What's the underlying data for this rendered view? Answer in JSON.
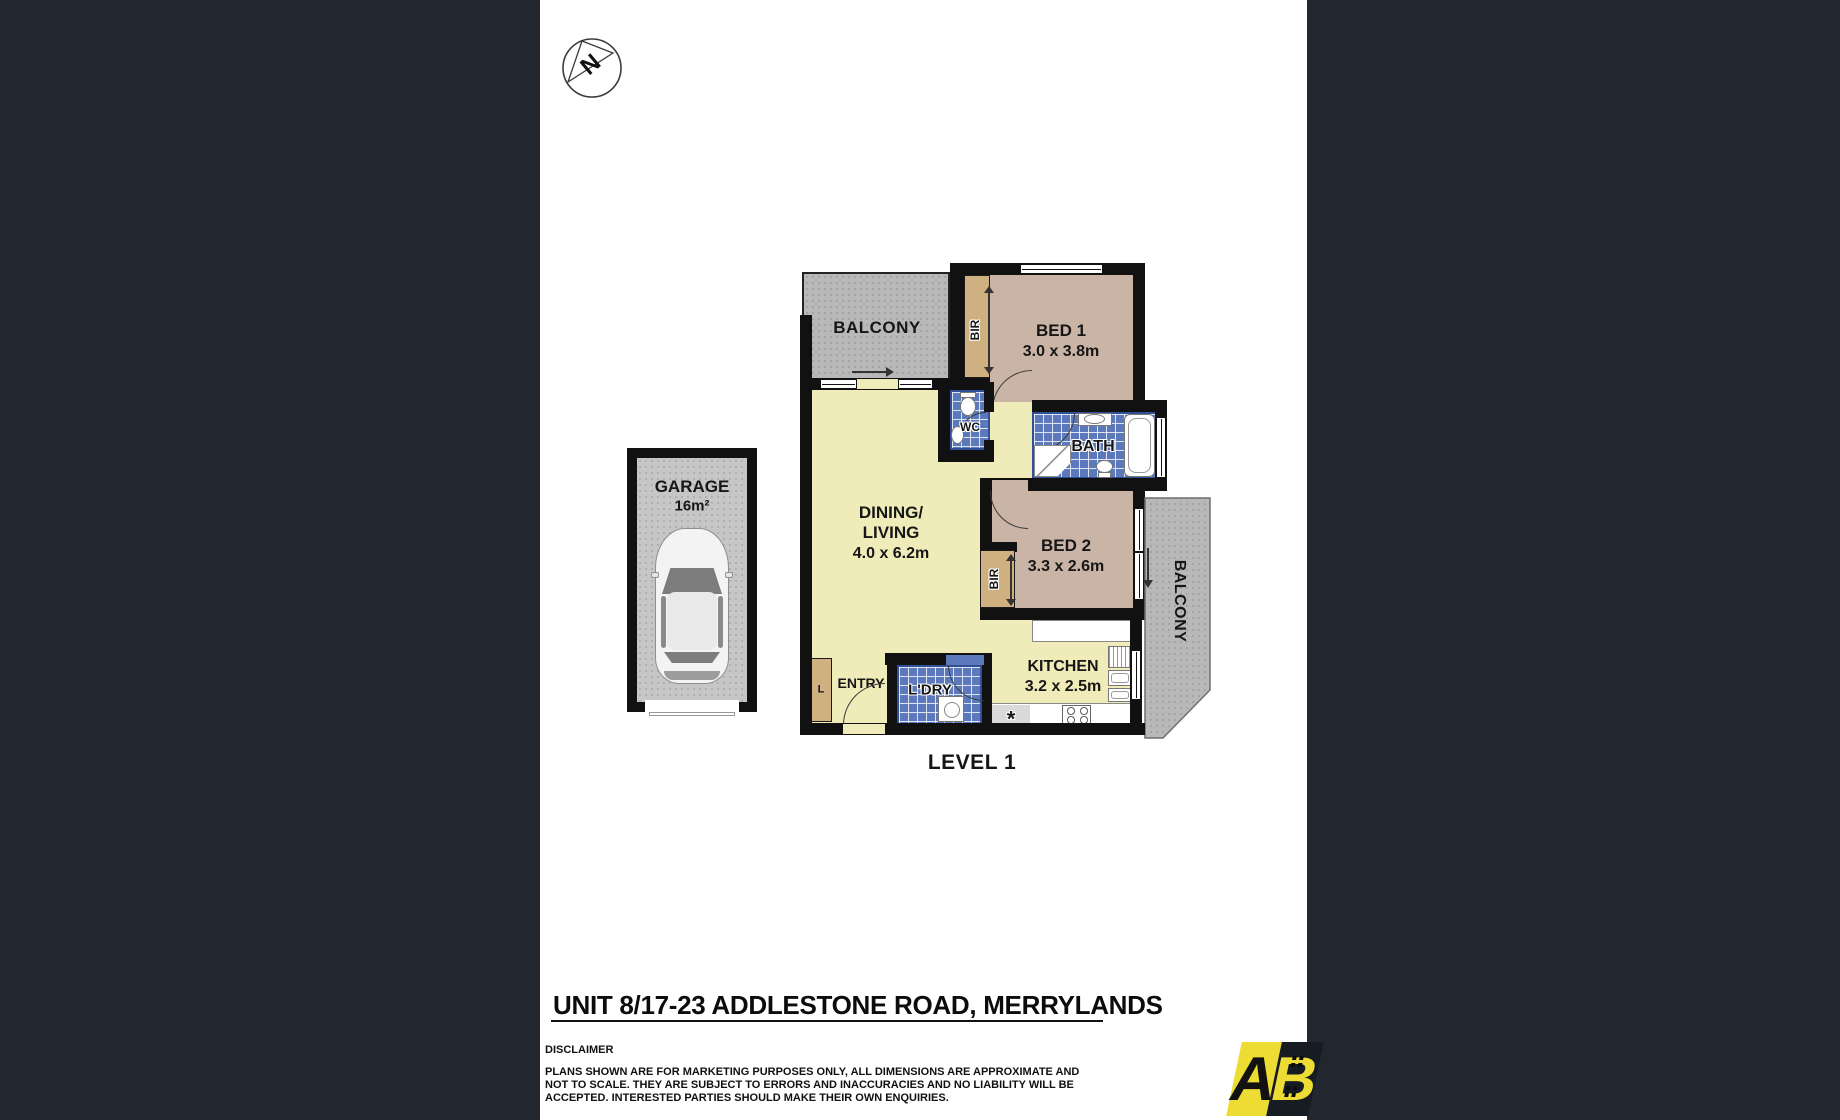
{
  "compass": {
    "label": "N"
  },
  "garage": {
    "name": "GARAGE",
    "area": "16m²"
  },
  "level": {
    "label": "LEVEL 1"
  },
  "rooms": {
    "balcony_top": {
      "label": "BALCONY"
    },
    "balcony_right": {
      "label": "BALCONY"
    },
    "bed1": {
      "name": "BED 1",
      "dims": "3.0 x 3.8m"
    },
    "bed2": {
      "name": "BED 2",
      "dims": "3.3 x 2.6m"
    },
    "bir1": {
      "label": "BIR"
    },
    "bir2": {
      "label": "BIR"
    },
    "wc": {
      "label": "WC"
    },
    "bath": {
      "label": "BATH"
    },
    "dining": {
      "line1": "DINING/",
      "line2": "LIVING",
      "dims": "4.0 x 6.2m"
    },
    "kitchen": {
      "name": "KITCHEN",
      "dims": "3.2 x 2.5m"
    },
    "laundry": {
      "label": "L'DRY"
    },
    "entry": {
      "label": "ENTRY"
    },
    "linen": {
      "label": "L"
    },
    "note": {
      "label": "*"
    }
  },
  "footer": {
    "title": "UNIT 8/17-23 ADDLESTONE ROAD, MERRYLANDS",
    "disclaimer_heading": "DISCLAIMER",
    "disclaimer_lines": [
      "PLANS SHOWN ARE FOR MARKETING PURPOSES ONLY, ALL DIMENSIONS ARE APPROXIMATE AND",
      "NOT TO SCALE. THEY ARE SUBJECT TO ERRORS AND INACCURACIES AND NO LIABILITY WILL BE",
      "ACCEPTED. INTERESTED PARTIES SHOULD MAKE THEIR OWN ENQUIRIES."
    ]
  },
  "logo": {
    "letter_a": "A",
    "letter_b": "B"
  },
  "palette": {
    "background_dark": "#22262e",
    "floor_yellow": "#f0ecba",
    "bedroom_tan": "#c9b4a6",
    "wardrobe_tan": "#cfb081",
    "tile_blue": "#5b79bb",
    "balcony_grey": "#b8b8b8",
    "garage_grey": "#c6c6c6",
    "wall_black": "#111111",
    "logo_yellow": "#ecdc33"
  }
}
